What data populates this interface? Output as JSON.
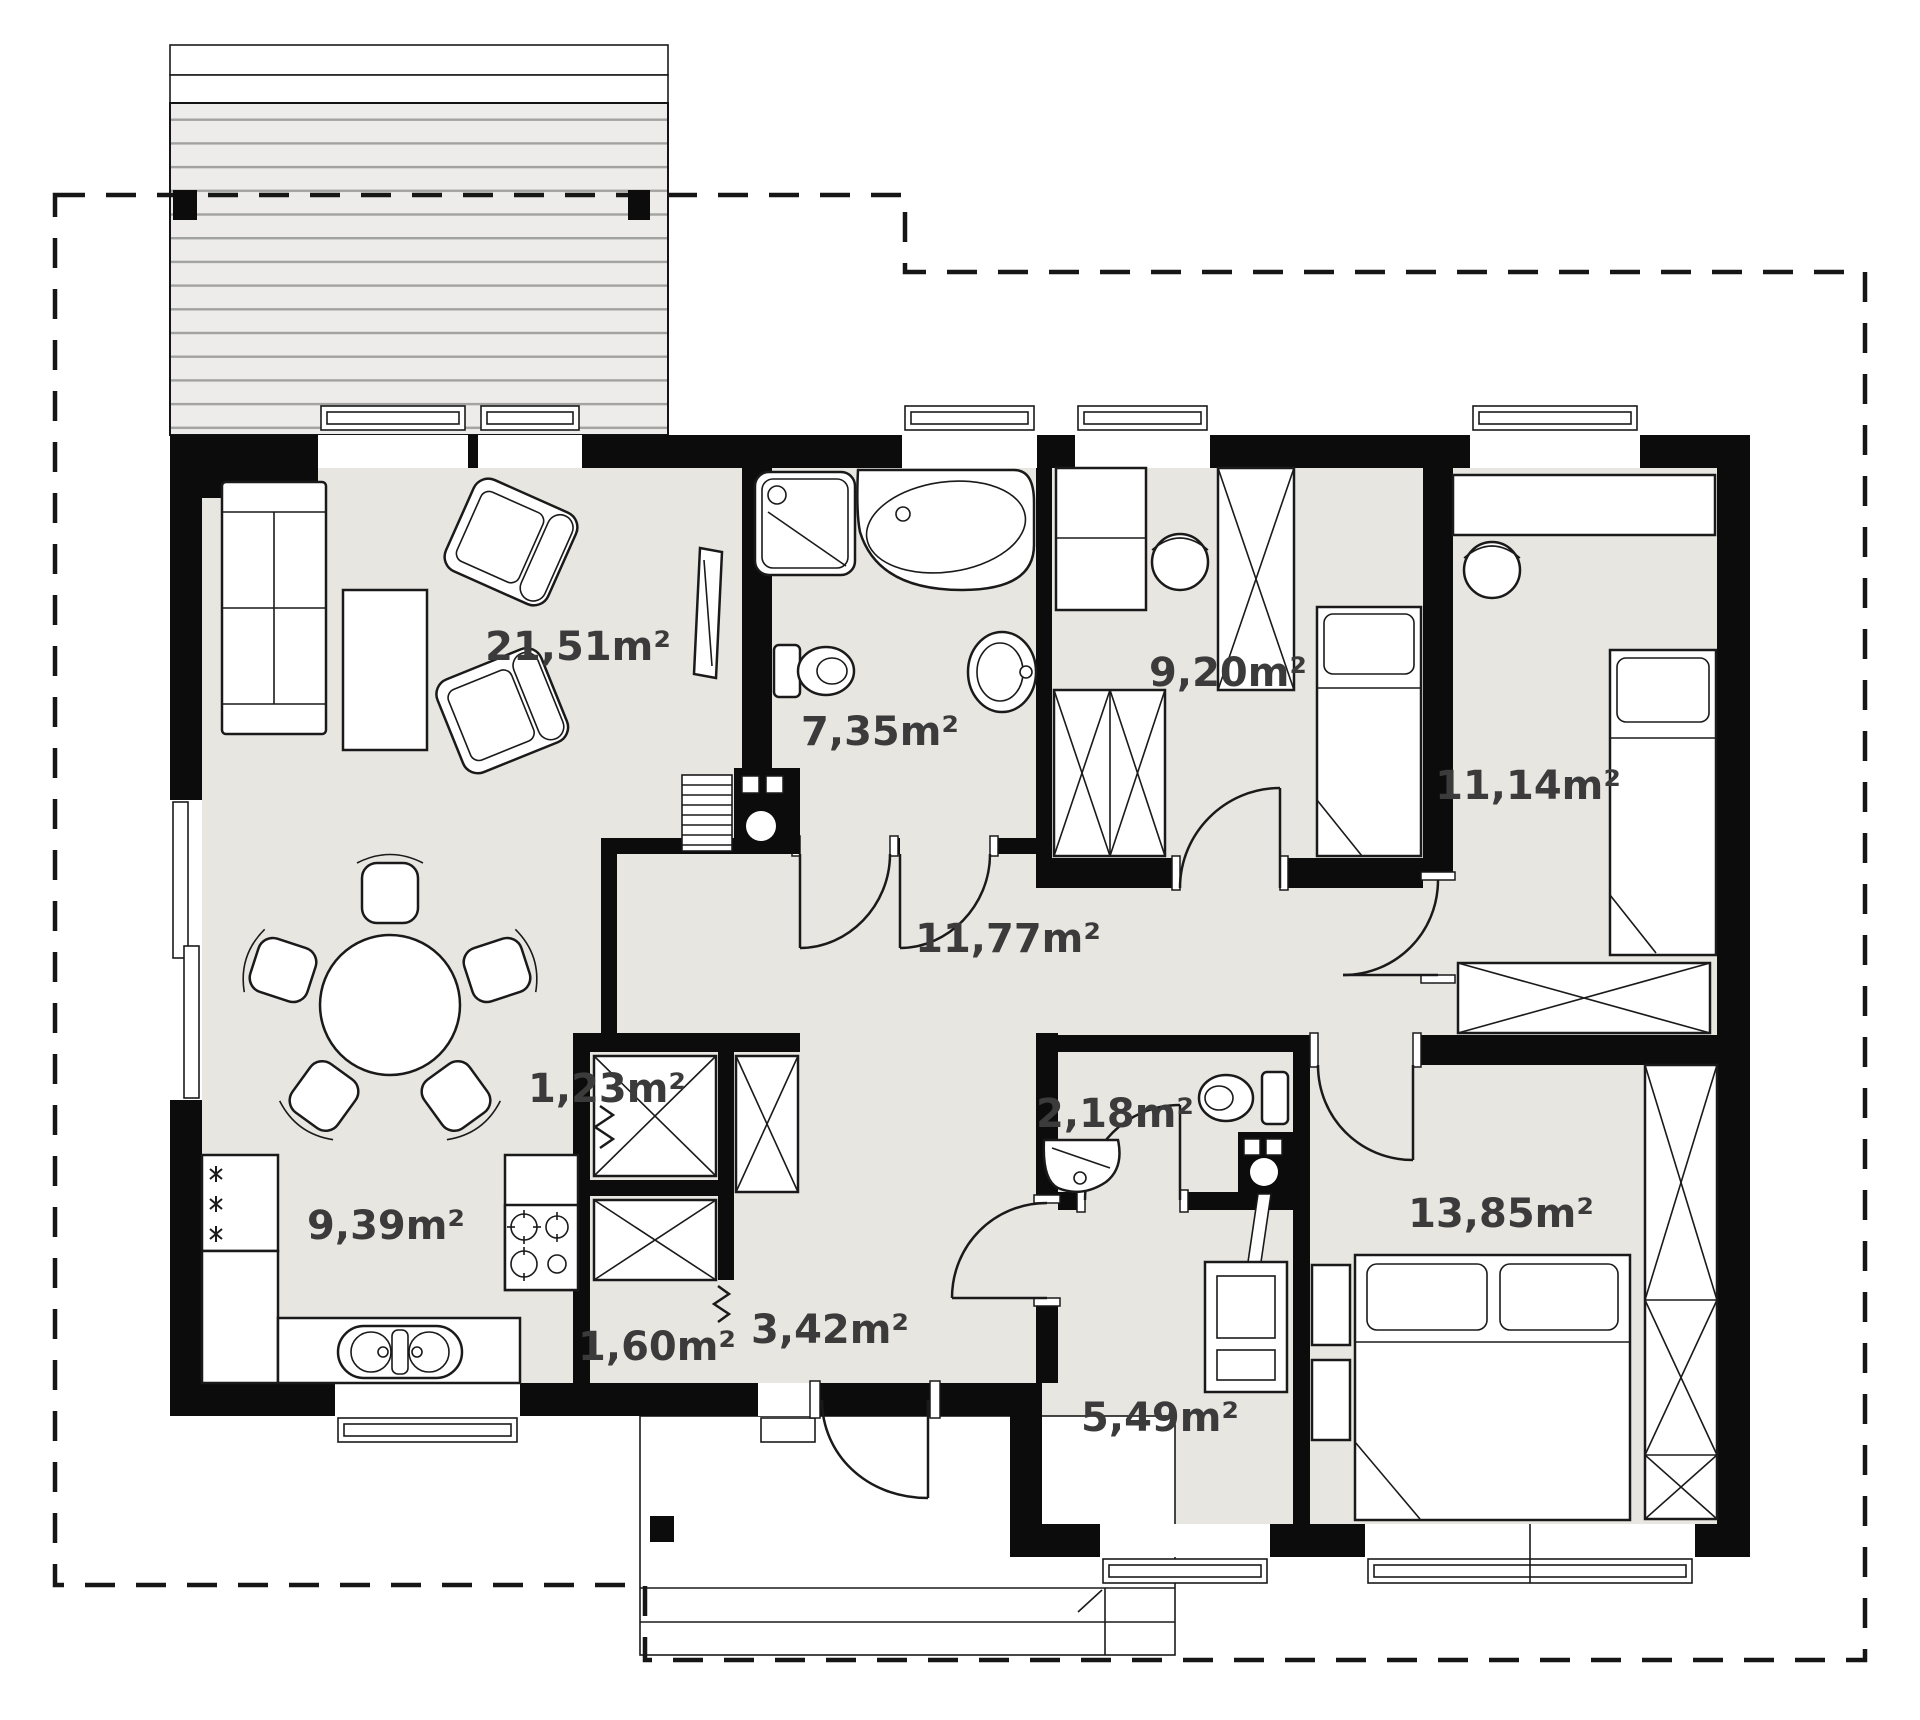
{
  "diagram": {
    "kind": "house floor plan",
    "area_unit": "m²",
    "rooms": {
      "living_room": {
        "label": "21,51m²"
      },
      "bathroom": {
        "label": "7,35m²"
      },
      "child_room_1": {
        "label": "9,20m²"
      },
      "child_room_2": {
        "label": "11,14m²"
      },
      "hall": {
        "label": "11,77m²"
      },
      "pantry": {
        "label": "1,23m²"
      },
      "kitchen": {
        "label": "9,39m²"
      },
      "wc": {
        "label": "2,18m²"
      },
      "closet": {
        "label": "1,60m²"
      },
      "entry_hall": {
        "label": "3,42m²"
      },
      "boiler_room": {
        "label": "5,49m²"
      },
      "bedroom": {
        "label": "13,85m²"
      }
    },
    "colors": {
      "wall": "#0c0c0c",
      "floor": "#e8e6e1",
      "terrace_floor": "#edecea",
      "terrace_stripe": "#a2a2a0",
      "label_text": "#3b3b3b",
      "background": "#ffffff"
    }
  }
}
